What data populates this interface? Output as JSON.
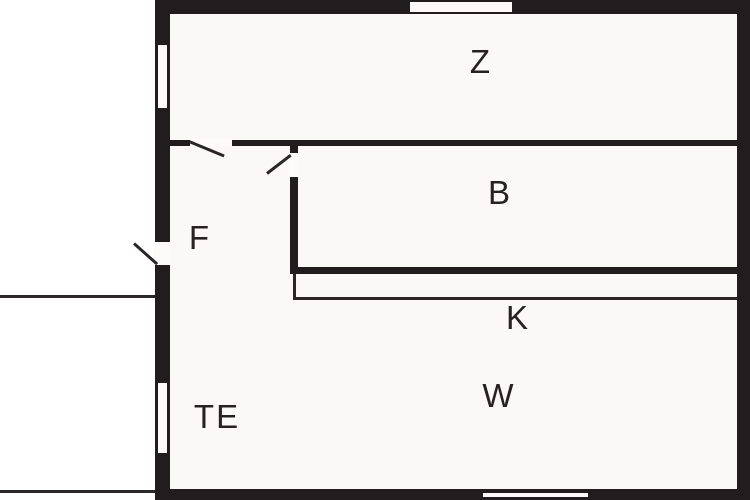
{
  "floorplan": {
    "rooms": [
      {
        "label": "Z"
      },
      {
        "label": "B"
      },
      {
        "label": "F"
      },
      {
        "label": "K"
      },
      {
        "label": "W"
      },
      {
        "label": "TE"
      }
    ],
    "colors": {
      "wall": "#211c1e",
      "interior_fill": "#faf9f7",
      "exterior_background": "#ffffff",
      "label_text": "#262223"
    }
  }
}
